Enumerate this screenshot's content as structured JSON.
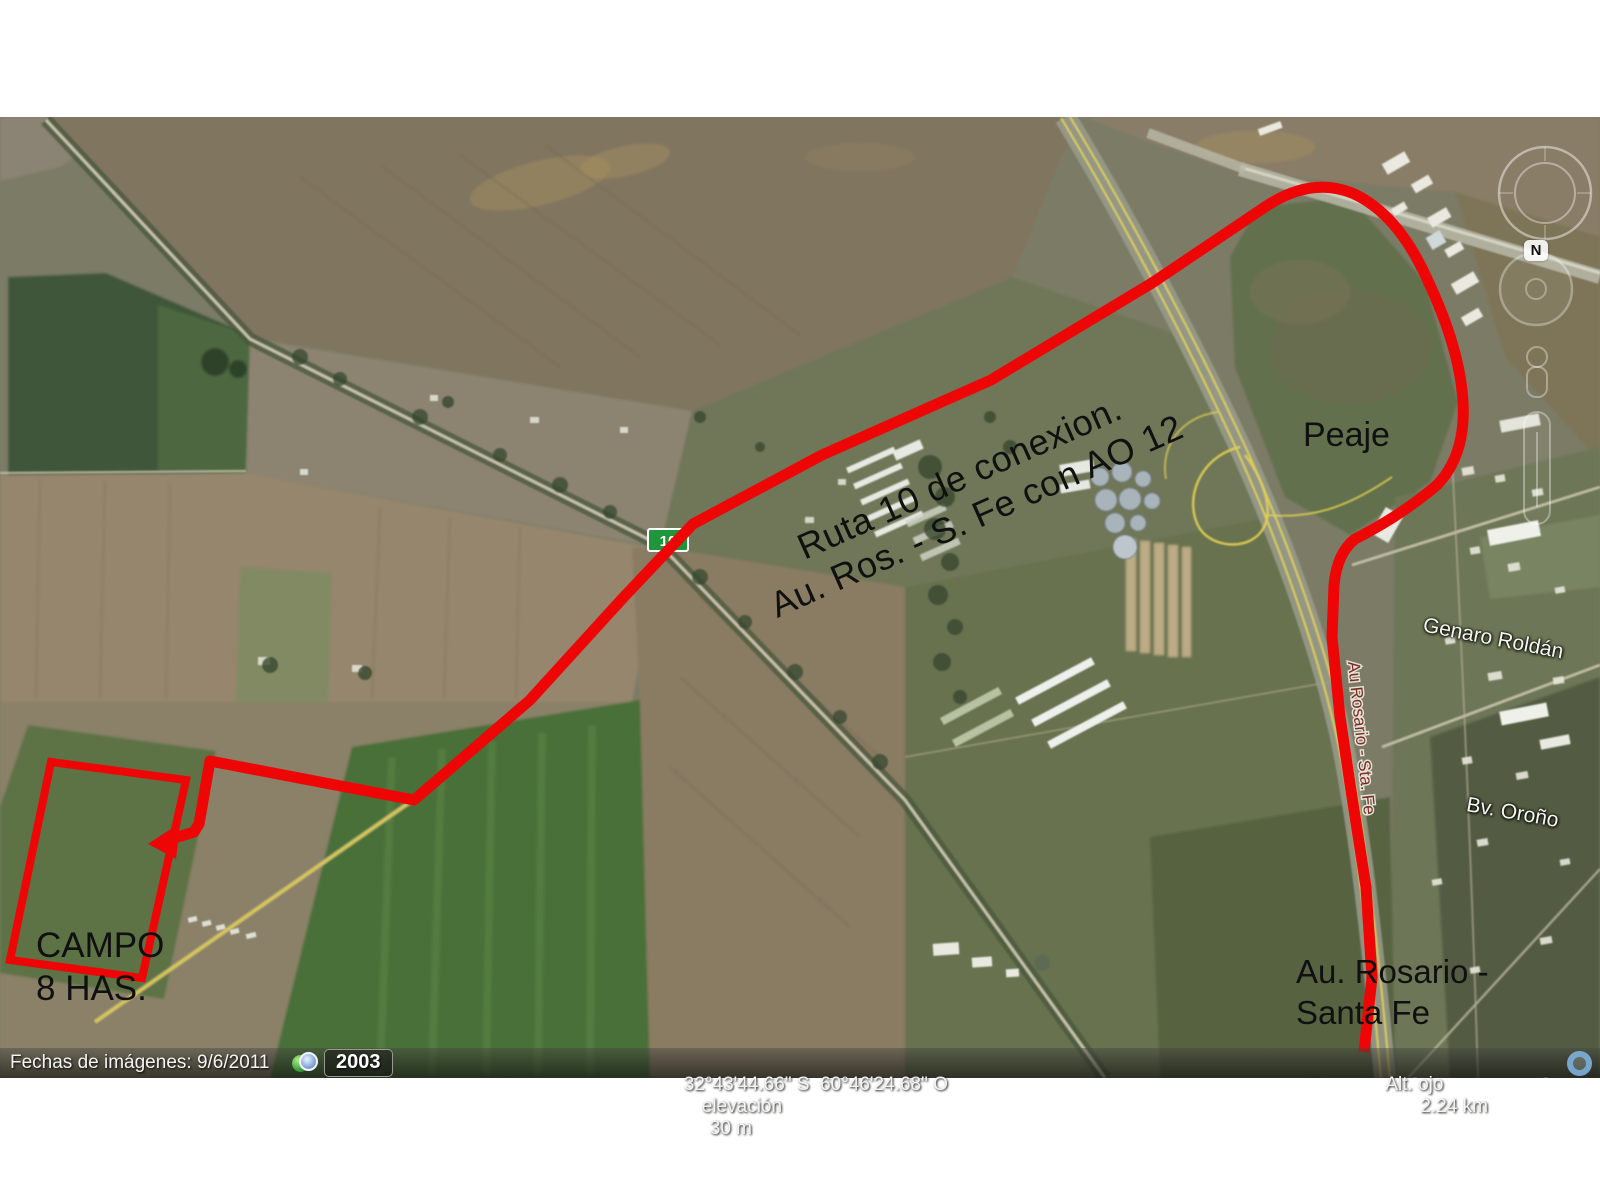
{
  "annotations": {
    "route_note_line1": "Ruta 10 de conexion.",
    "route_note_line2": "Au. Ros. - S. Fe con AO 12",
    "toll": "Peaje",
    "campo_line1": "CAMPO",
    "campo_line2": "8 HAS.",
    "highway_line1": "Au. Rosario -",
    "highway_line2": "Santa Fe"
  },
  "road_labels": {
    "genaro_roldan": "Genaro Roldán",
    "bv_orono": "Bv. Oroño",
    "highway_inline": "Au Rosario - Sta. Fe",
    "route_shield": "10"
  },
  "watermark": {
    "brand": "Google",
    "product": "earth"
  },
  "copyright": {
    "line1": "© 2012 Inav/Geosistemas SRL",
    "line2": "Image © 2012 DigitalGlobe"
  },
  "status_bar": {
    "imagery_date": "Fechas de imágenes: 9/6/2011",
    "history_year": "2003",
    "coordinates": "32°43'44.66\" S  60°46'24.68\" O",
    "elevation_label": "elevación",
    "elevation_value": "30 m",
    "eye_alt_label": "Alt. ojo",
    "eye_alt_value": "2.24 km"
  },
  "compass": {
    "north": "N"
  },
  "colors": {
    "route": "#ee0505",
    "shield": "#1e9639",
    "road_yellow": "#e0cf52"
  }
}
